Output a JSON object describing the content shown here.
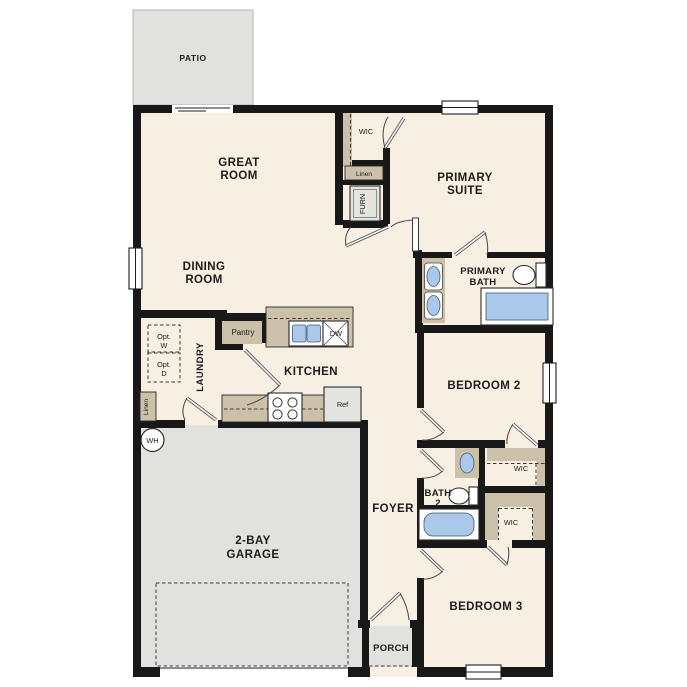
{
  "plan": {
    "labels": {
      "patio": "PATIO",
      "great_room": [
        "GREAT",
        "ROOM"
      ],
      "dining_room": [
        "DINING",
        "ROOM"
      ],
      "primary_suite": [
        "PRIMARY",
        "SUITE"
      ],
      "primary_bath": [
        "PRIMARY",
        "BATH"
      ],
      "wic_primary": "WIC",
      "linen_hall": "Linen",
      "furnace": "FURN",
      "pantry": "Pantry",
      "laundry": "LAUNDRY",
      "opt_washer": [
        "Opt.",
        "W"
      ],
      "opt_dryer": [
        "Opt.",
        "D"
      ],
      "linen_laundry": "Linen",
      "water_heater": "WH",
      "kitchen": "KITCHEN",
      "dishwasher": "DW",
      "refrigerator": "Ref",
      "bedroom2": "BEDROOM 2",
      "wic_bedroom2": "WIC",
      "bath2": [
        "BATH",
        "2"
      ],
      "wic_bedroom3": "WIC",
      "foyer": "FOYER",
      "garage": [
        "2-BAY",
        "GARAGE"
      ],
      "bedroom3": "BEDROOM 3",
      "porch": "PORCH"
    },
    "colors": {
      "wall": "#181818",
      "interior_floor": "#f6efe2",
      "concrete_gray": "#e1e1df",
      "casework_tan": "#ccc0a9",
      "fixture_blue": "#aac9ea",
      "text": "#1c1c1c"
    }
  }
}
